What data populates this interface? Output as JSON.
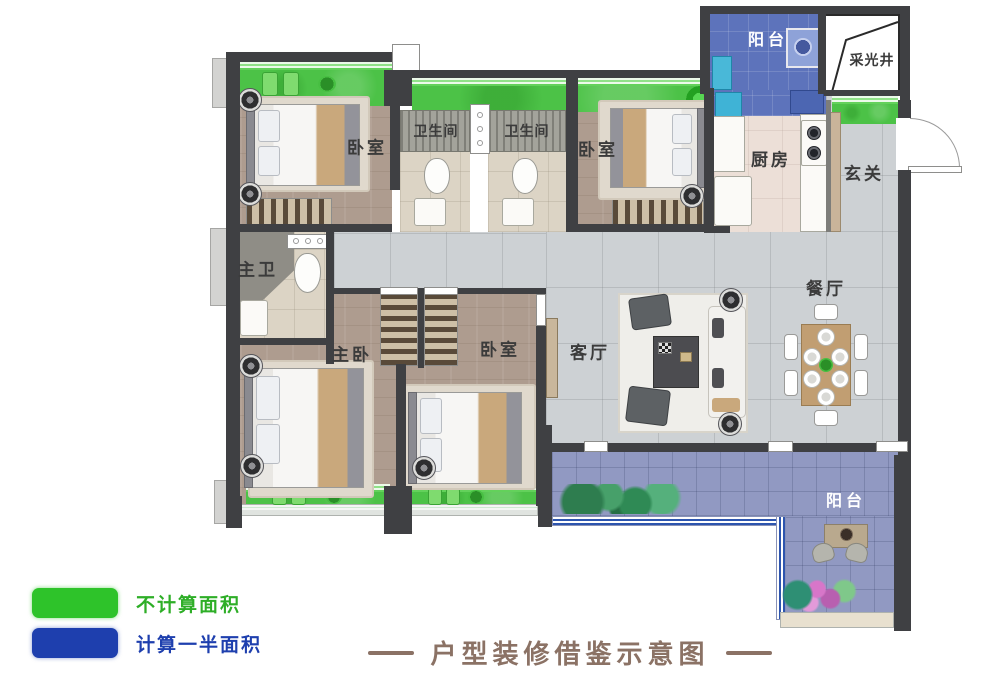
{
  "title": {
    "text": "户型装修借鉴示意图"
  },
  "legend": {
    "items": [
      {
        "label": "不计算面积",
        "color": "#2ec32a"
      },
      {
        "label": "计算一半面积",
        "color": "#1e3fae"
      }
    ]
  },
  "rooms": {
    "bedroom_top_left": "卧室",
    "bathroom_1": "卫生间",
    "bathroom_2": "卫生间",
    "bedroom_top_right": "卧室",
    "kitchen": "厨房",
    "entry": "玄关",
    "balcony_top": "阳台",
    "light_well": "采光井",
    "master_bathroom": "主卫",
    "master_bedroom": "主卧",
    "bedroom_bottom": "卧室",
    "living_room": "客厅",
    "dining_room": "餐厅",
    "balcony_bottom": "阳台"
  },
  "colors": {
    "no_area_green": "#2ec32a",
    "half_area_blue": "#1e3fae",
    "title_brown": "#8b7265",
    "wall_dark": "#3f4043",
    "balcony_top_blue": "#5d73bb",
    "balcony_bottom_blue": "#9199c2",
    "bay_window_green": "#4cc247"
  }
}
